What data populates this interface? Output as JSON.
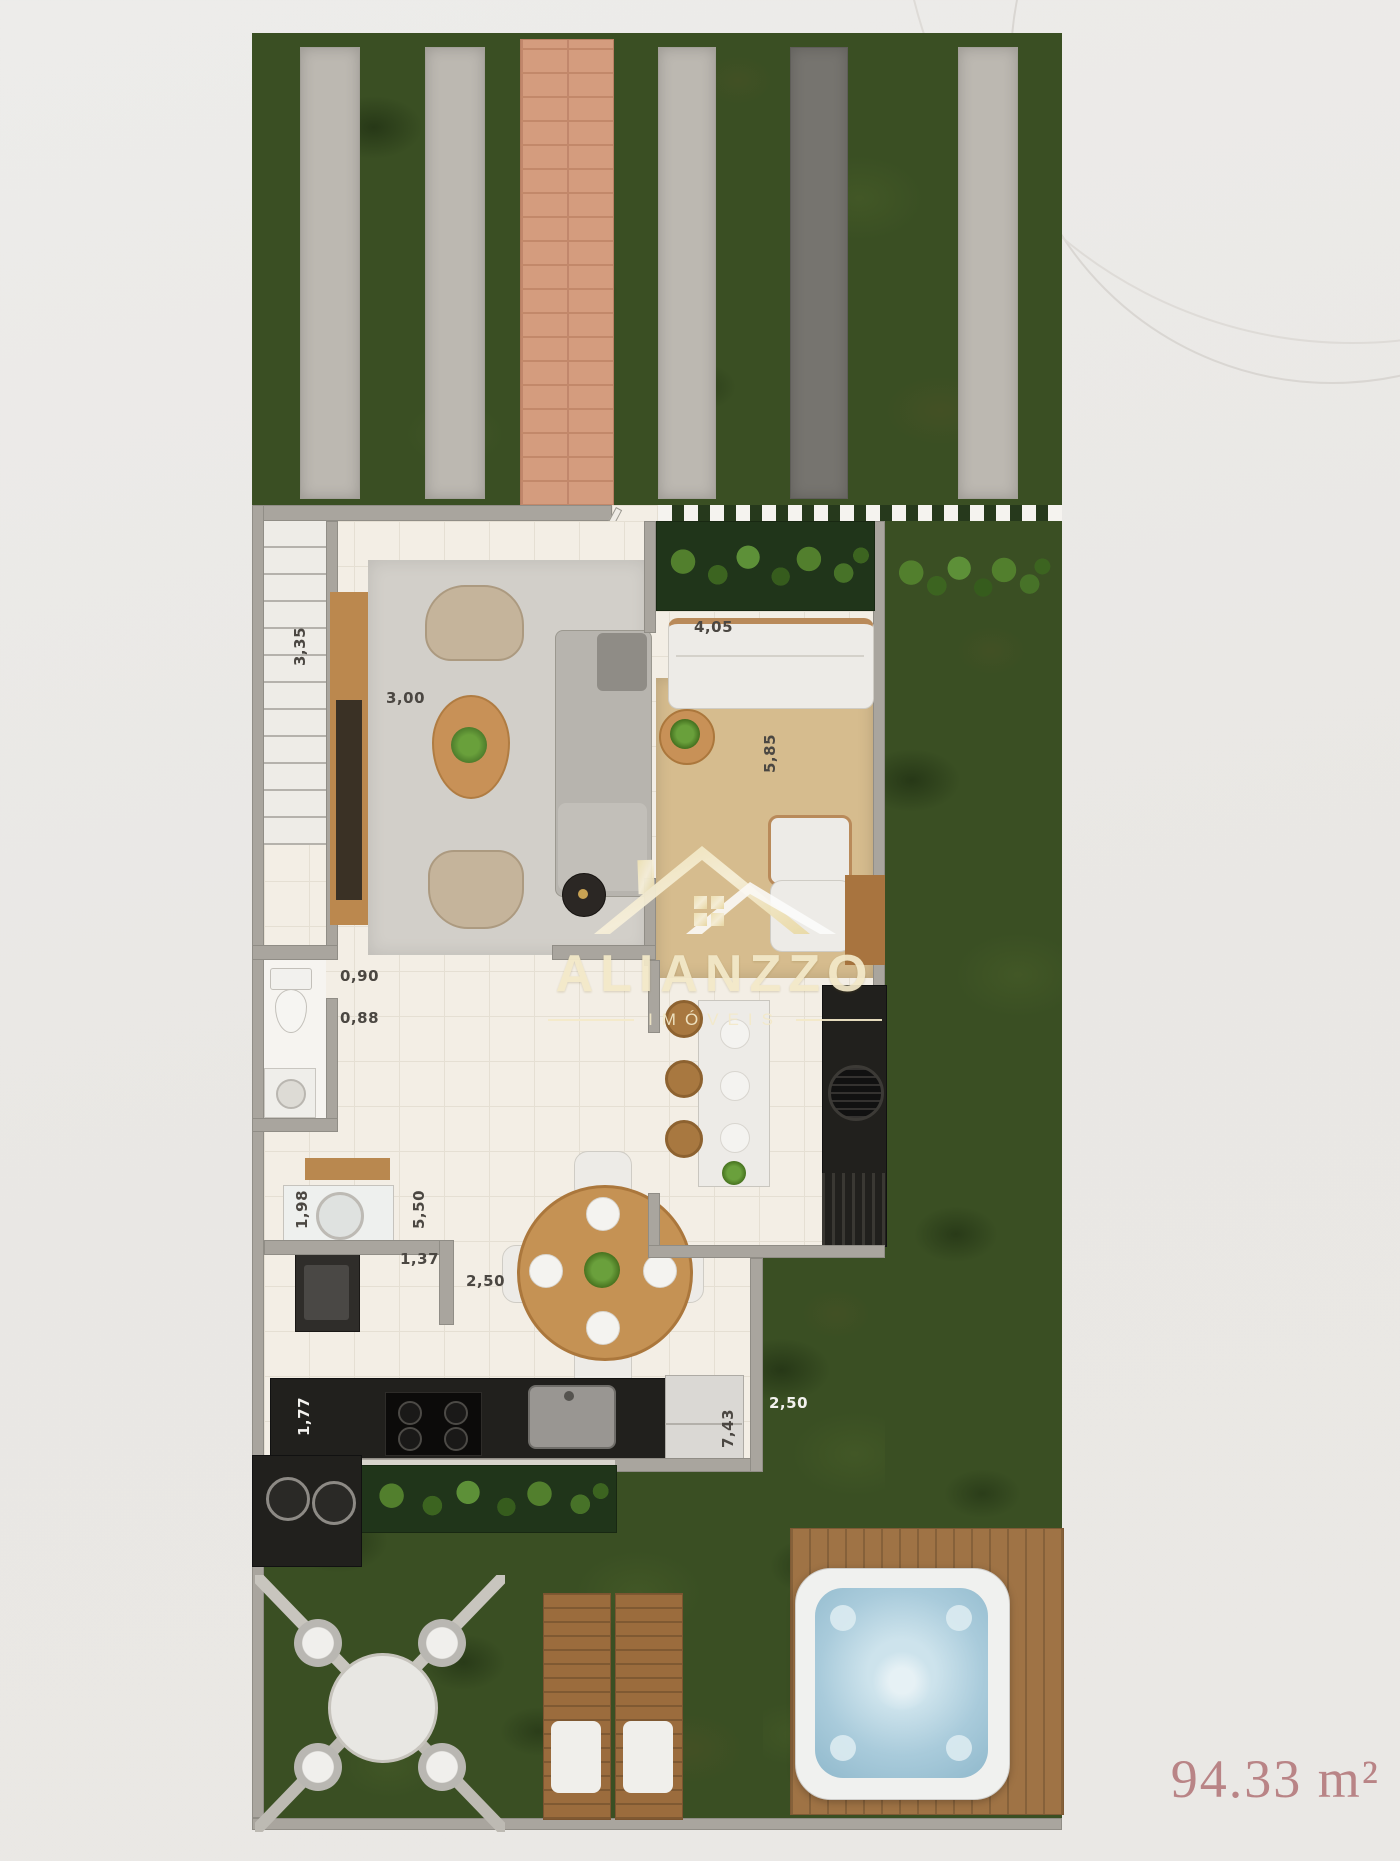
{
  "plan": {
    "area_label": "94.33 m²",
    "dimension_labels": {
      "stairs_width": "3,35",
      "living_width": "3,00",
      "entry_width": "4,05",
      "terrace_depth": "5,85",
      "lavabo_door": "0,90",
      "lavabo_width": "0,88",
      "laundry_depth": "1,98",
      "kitchen_depth": "5,50",
      "dining_offset": "1,37",
      "dining_width": "2,50",
      "counter_depth": "1,77",
      "kitchen_run": "7,43",
      "side_garden_width": "2,50"
    }
  },
  "watermark": {
    "brand": "ALIANZZO",
    "tagline": "IMÓVEIS",
    "icon": "house-roof-icon"
  },
  "colors": {
    "background": "#eae8e5",
    "grass": "#3a4f23",
    "paver": "#bcb8b1",
    "brick_path": "#d49c7e",
    "wall": "#a9a59e",
    "floor": "#f3eee5",
    "counter_black": "#21201d",
    "wood": "#bb884e",
    "terrace_mat": "#d6bc8e",
    "hot_tub_water": "#a9cbdb",
    "area_text": "#b98486",
    "logo_gold": "#f3e9c9"
  }
}
